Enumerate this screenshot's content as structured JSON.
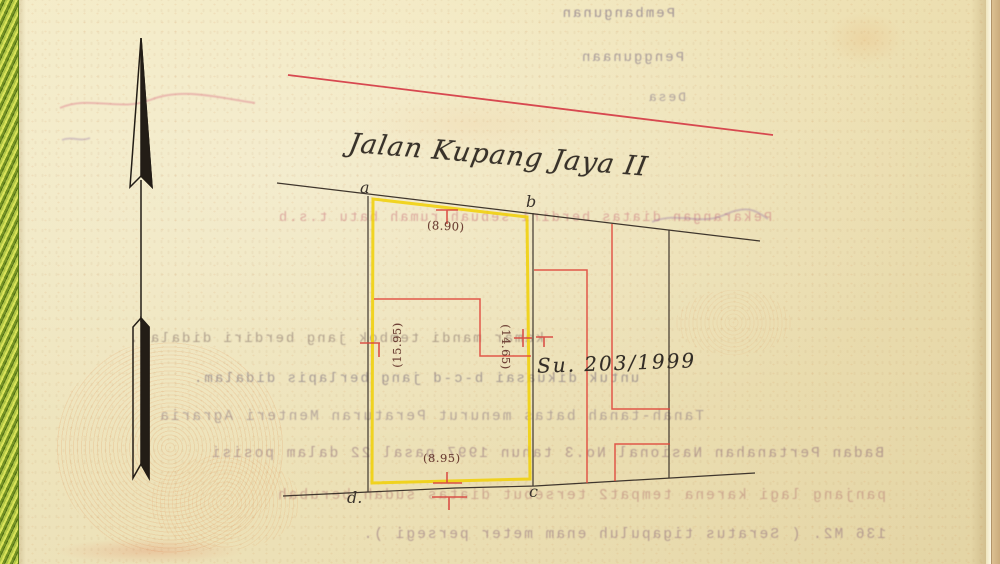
{
  "title": "Jalan Kupang Jaya II",
  "survey_number": "Su. 203/1999",
  "plot": {
    "corner_labels": {
      "a": "a",
      "b": "b",
      "c": "c",
      "d": "d."
    },
    "measurements": {
      "top": "(8.90)",
      "left": "(15.95)",
      "middle": "(14.65)",
      "bottom": "(8.95)"
    }
  },
  "icons": {
    "compass": "north-arrow"
  },
  "colors": {
    "paper": "#f6edc4",
    "binding_green": "#8fae2e",
    "plot_outline_yellow": "#f0d00a",
    "survey_line_red": "#e0483c",
    "road_line_red": "#d6404a",
    "boundary_ink": "#3f362d"
  },
  "bleedthrough_lines": [
    {
      "text": "Pembangunan",
      "mirrored": true
    },
    {
      "text": "Penggunaan",
      "mirrored": true
    },
    {
      "text": "Desa",
      "mirrored": true
    },
    {
      "text": "Pekarangan diatas berdiri sebuah rumah batu t.s.b.",
      "mirrored": true
    },
    {
      "text": "kamar mandi tembok jang berdiri didalam.",
      "mirrored": true
    },
    {
      "text": "untuk dikuasai b-c-d jang berlapis didalam.",
      "mirrored": true
    },
    {
      "text": "Tanah-tanah batas menurut Peraturan Menteri Agraria",
      "mirrored": true
    },
    {
      "text": "Badan Pertanahan Nasional No.3 tahun 1997 pasal 22 dalam posisi",
      "mirrored": true
    },
    {
      "text": "panjang lagi karena tempat2 tersebut diatas sudah berubah",
      "mirrored": true
    },
    {
      "text": "136 M2. ( Seratus tigapuluh enam meter persegi ).",
      "mirrored": true
    }
  ]
}
